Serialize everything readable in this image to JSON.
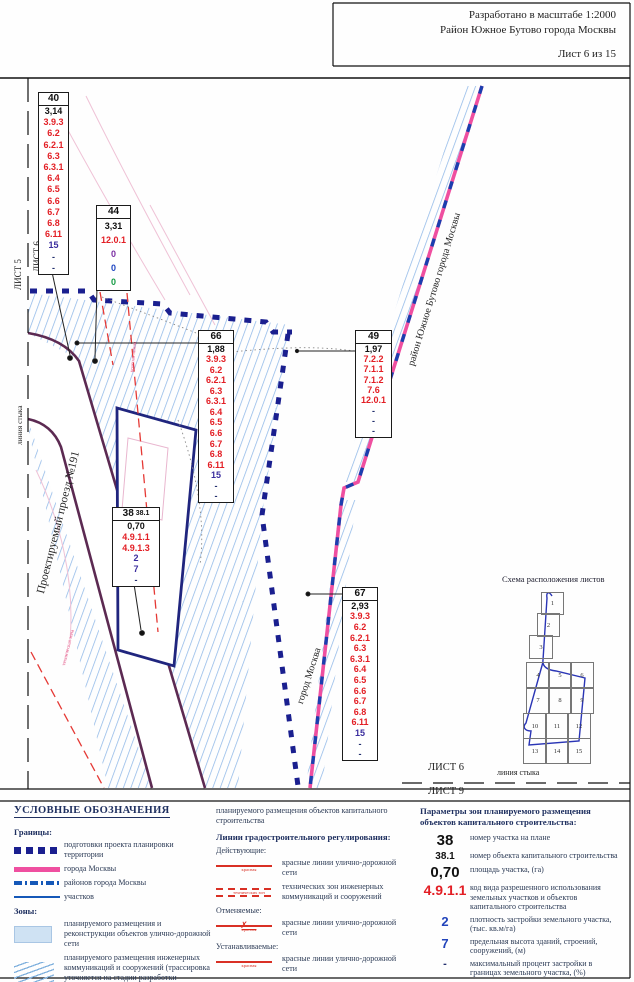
{
  "header": {
    "scale_line": "Разработано в масштабе 1:2000",
    "district_line": "Район Южное Бутово города Москвы",
    "sheet_line": "Лист 6 из 15"
  },
  "map_labels": {
    "sheet_left_right": "ЛИСТ 6",
    "sheet_left_left": "ЛИСТ 5",
    "seam_left": "линия стыка",
    "street": "Проектируемый проезд №191",
    "city": "город Москва",
    "district_boundary": "район Южное Бутово города Москвы",
    "red_line_note": "красная линия",
    "tech_zone_note": "техническая зона",
    "sheet_bottom_top": "ЛИСТ 6",
    "sheet_bottom_bottom": "ЛИСТ 9",
    "seam_bottom": "линия стыка"
  },
  "parcels": [
    {
      "id": "40",
      "x": 38,
      "y": 92,
      "w": 29,
      "h": 181,
      "rows": [
        [
          "3,14",
          "k"
        ],
        [
          "3.9.3",
          "r"
        ],
        [
          "6.2",
          "r"
        ],
        [
          "6.2.1",
          "r"
        ],
        [
          "6.3",
          "r"
        ],
        [
          "6.3.1",
          "r"
        ],
        [
          "6.4",
          "r"
        ],
        [
          "6.5",
          "r"
        ],
        [
          "6.6",
          "r"
        ],
        [
          "6.7",
          "r"
        ],
        [
          "6.8",
          "r"
        ],
        [
          "6.11",
          "r"
        ],
        [
          "15",
          "i"
        ],
        [
          "-",
          "d"
        ],
        [
          "-",
          "d"
        ]
      ]
    },
    {
      "id": "44",
      "x": 96,
      "y": 205,
      "w": 33,
      "h": 84,
      "rows": [
        [
          "3,31",
          "k"
        ],
        [
          "12.0.1",
          "r"
        ],
        [
          "0",
          "p"
        ],
        [
          "0",
          "b"
        ],
        [
          "0",
          "g"
        ]
      ]
    },
    {
      "id": "66",
      "x": 198,
      "y": 330,
      "w": 34,
      "h": 171,
      "rows": [
        [
          "1,88",
          "k"
        ],
        [
          "3.9.3",
          "r"
        ],
        [
          "6.2",
          "r"
        ],
        [
          "6.2.1",
          "r"
        ],
        [
          "6.3",
          "r"
        ],
        [
          "6.3.1",
          "r"
        ],
        [
          "6.4",
          "r"
        ],
        [
          "6.5",
          "r"
        ],
        [
          "6.6",
          "r"
        ],
        [
          "6.7",
          "r"
        ],
        [
          "6.8",
          "r"
        ],
        [
          "6.11",
          "r"
        ],
        [
          "15",
          "i"
        ],
        [
          "-",
          "d"
        ],
        [
          "-",
          "d"
        ]
      ]
    },
    {
      "id": "49",
      "x": 355,
      "y": 330,
      "w": 35,
      "h": 106,
      "rows": [
        [
          "1,97",
          "k"
        ],
        [
          "7.2.2",
          "r"
        ],
        [
          "7.1.1",
          "r"
        ],
        [
          "7.1.2",
          "r"
        ],
        [
          "7.6",
          "r"
        ],
        [
          "12.0.1",
          "r"
        ],
        [
          "-",
          "d"
        ],
        [
          "-",
          "d"
        ],
        [
          "-",
          "d"
        ]
      ]
    },
    {
      "id": "38",
      "id2": "38.1",
      "x": 112,
      "y": 507,
      "w": 46,
      "h": 78,
      "rows": [
        [
          "0,70",
          "k"
        ],
        [
          "4.9.1.1",
          "r"
        ],
        [
          "4.9.1.3",
          "r"
        ],
        [
          "2",
          "i"
        ],
        [
          "7",
          "i"
        ],
        [
          "-",
          "d"
        ]
      ]
    },
    {
      "id": "67",
      "x": 342,
      "y": 587,
      "w": 34,
      "h": 172,
      "rows": [
        [
          "2,93",
          "k"
        ],
        [
          "3.9.3",
          "r"
        ],
        [
          "6.2",
          "r"
        ],
        [
          "6.2.1",
          "r"
        ],
        [
          "6.3",
          "r"
        ],
        [
          "6.3.1",
          "r"
        ],
        [
          "6.4",
          "r"
        ],
        [
          "6.5",
          "r"
        ],
        [
          "6.6",
          "r"
        ],
        [
          "6.7",
          "r"
        ],
        [
          "6.8",
          "r"
        ],
        [
          "6.11",
          "r"
        ],
        [
          "15",
          "i"
        ],
        [
          "-",
          "d"
        ],
        [
          "-",
          "d"
        ]
      ]
    }
  ],
  "schema": {
    "title": "Схема расположения листов",
    "sheets": [
      {
        "n": "1",
        "x": 541,
        "y": 592,
        "w": 21,
        "h": 21
      },
      {
        "n": "2",
        "x": 537,
        "y": 613,
        "w": 21,
        "h": 22
      },
      {
        "n": "3",
        "x": 529,
        "y": 635,
        "w": 22,
        "h": 22
      },
      {
        "n": "4",
        "x": 526,
        "y": 662,
        "w": 22,
        "h": 25
      },
      {
        "n": "5",
        "x": 548,
        "y": 662,
        "w": 22,
        "h": 25
      },
      {
        "n": "6",
        "x": 570,
        "y": 662,
        "w": 22,
        "h": 25
      },
      {
        "n": "7",
        "x": 526,
        "y": 687,
        "w": 22,
        "h": 25
      },
      {
        "n": "8",
        "x": 548,
        "y": 687,
        "w": 22,
        "h": 25
      },
      {
        "n": "9",
        "x": 570,
        "y": 687,
        "w": 22,
        "h": 25
      },
      {
        "n": "10",
        "x": 523,
        "y": 713,
        "w": 22,
        "h": 24
      },
      {
        "n": "11",
        "x": 545,
        "y": 713,
        "w": 22,
        "h": 24
      },
      {
        "n": "12",
        "x": 567,
        "y": 713,
        "w": 22,
        "h": 24
      },
      {
        "n": "13",
        "x": 523,
        "y": 738,
        "w": 22,
        "h": 24
      },
      {
        "n": "14",
        "x": 545,
        "y": 738,
        "w": 22,
        "h": 24
      },
      {
        "n": "15",
        "x": 567,
        "y": 738,
        "w": 22,
        "h": 24
      }
    ]
  },
  "legend": {
    "title": "УСЛОВНЫЕ ОБОЗНАЧЕНИЯ",
    "groups_left": [
      {
        "heading": "Границы:",
        "items": [
          {
            "swatch": "navy-squares",
            "text": "подготовки проекта планировки территории"
          },
          {
            "swatch": "magenta-line",
            "text": "города Москвы"
          },
          {
            "swatch": "blue-dashdot",
            "text": "районов города Москвы"
          },
          {
            "swatch": "blue-thin",
            "text": "участков"
          }
        ]
      },
      {
        "heading": "Зоны:",
        "items": [
          {
            "swatch": "lightblue-rect",
            "text": "планируемого размещения и реконструкции объектов улично-дорожной сети"
          },
          {
            "swatch": "hatch",
            "text": "планируемого размещения инженерных коммуникаций и сооружений (трассировка уточняется на стадии разработки проектной документации)"
          }
        ]
      }
    ],
    "zone_continuation": "планируемого размещения объектов капитального строительства",
    "mid_title": "Линии градостроительного регулирования:",
    "mid_groups": [
      {
        "heading": "Действующие:",
        "items": [
          {
            "swatch": "red-line",
            "caption": "красная",
            "text": "красные линии улично-дорожной сети"
          },
          {
            "swatch": "red-dash",
            "caption": "технических зон",
            "text": "технических зон инженерных коммуникаций и сооружений"
          }
        ]
      },
      {
        "heading": "Отменяемые:",
        "items": [
          {
            "swatch": "red-x",
            "caption": "красная",
            "text": "красные линии улично-дорожной сети"
          }
        ]
      },
      {
        "heading": "Устанавливаемые:",
        "items": [
          {
            "swatch": "red-line",
            "caption": "красная",
            "text": "красные линии улично-дорожной сети"
          }
        ]
      }
    ]
  },
  "params": {
    "title": "Параметры зон планируемого размещения объектов капитального строительства:",
    "rows": [
      {
        "key": "38",
        "cls": "pk-big",
        "desc": "номер участка на плане"
      },
      {
        "key": "38.1",
        "cls": "pk-small",
        "desc": "номер объекта капитального строительства"
      },
      {
        "key": "0,70",
        "cls": "pk-big",
        "desc": "площадь участка, (га)"
      },
      {
        "key": "4.9.1.1",
        "cls": "pk-red",
        "desc": "код вида разрешенного использования земельных участков и объектов капитального строительства"
      },
      {
        "key": "2",
        "cls": "pk-blue",
        "desc": "плотность застройки земельного участка, (тыс. кв.м/га)"
      },
      {
        "key": "7",
        "cls": "pk-blue",
        "desc": "предельная высота зданий, строений, сооружений, (м)"
      },
      {
        "key": "-",
        "cls": "pk-dash",
        "desc": "максимальный процент застройки в границах земельного участка, (%)"
      }
    ]
  },
  "colors": {
    "red_line": "#e31e24",
    "navy_boundary": "#1a1f8f",
    "magenta_boundary": "#ef4fa0",
    "road_purple": "#5c2a52",
    "hatch_blue": "#8fb8e8",
    "indigo": "#3a2d9e",
    "blue": "#1f46c2",
    "green": "#149a43",
    "purple": "#7b2fa3"
  }
}
